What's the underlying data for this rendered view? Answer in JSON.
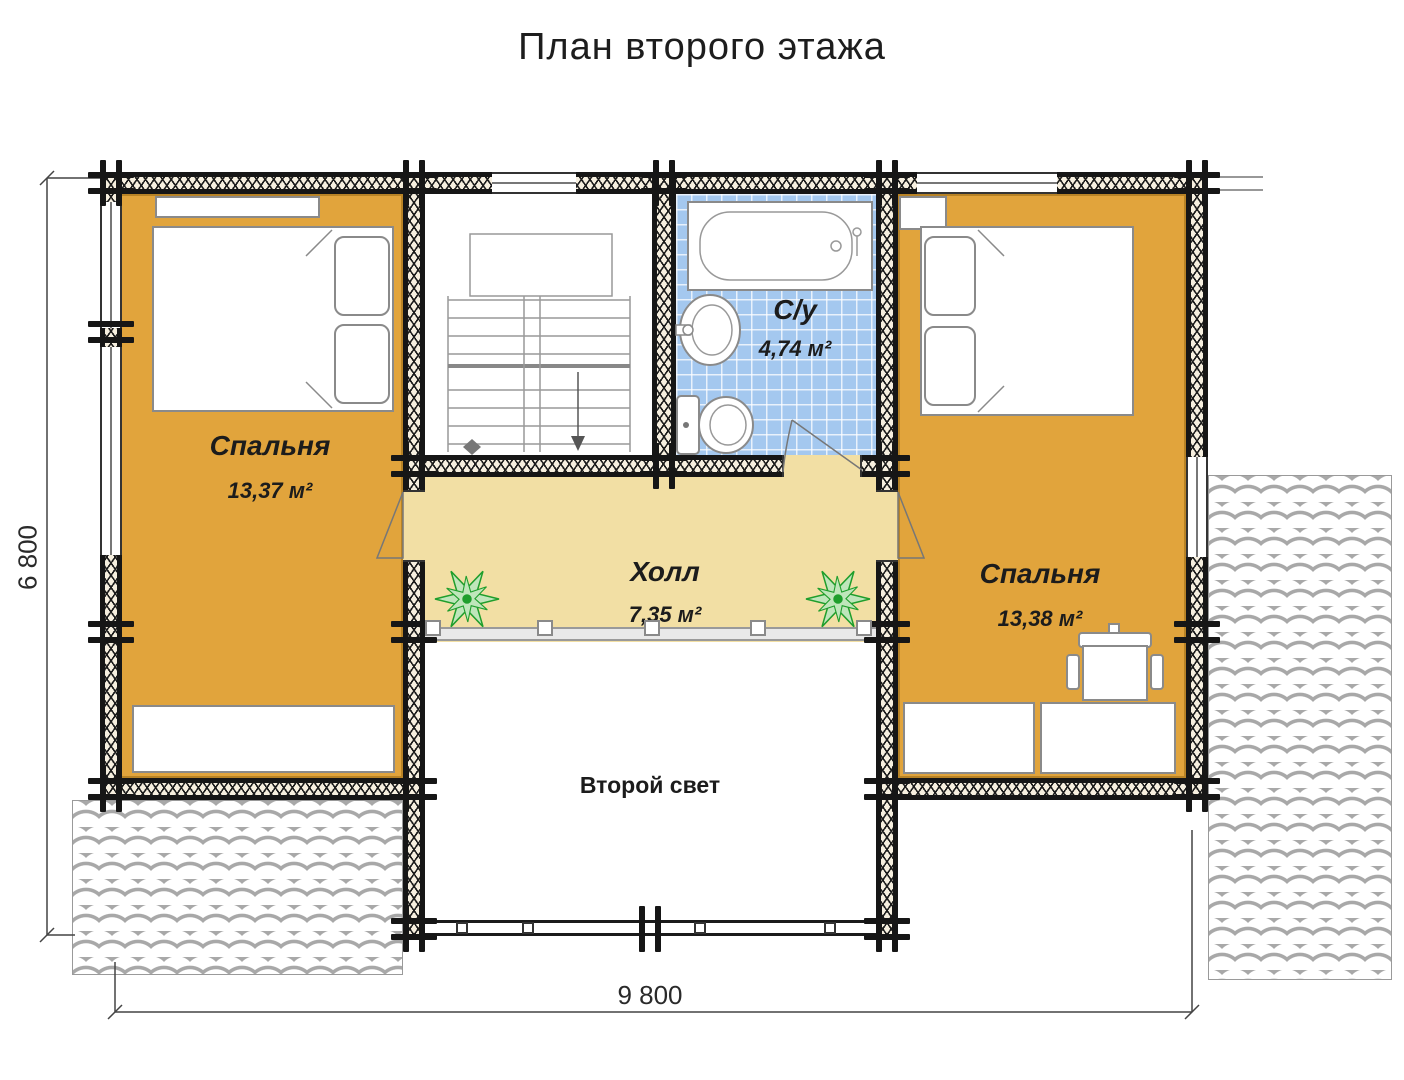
{
  "title": "План второго этажа",
  "rooms": {
    "bedroom_left": {
      "name": "Спальня",
      "area": "13,37 м²"
    },
    "bathroom": {
      "name": "С/у",
      "area": "4,74 м²"
    },
    "hall": {
      "name": "Холл",
      "area": "7,35 м²"
    },
    "bedroom_right": {
      "name": "Спальня",
      "area": "13,38 м²"
    },
    "void": {
      "name": "Второй свет"
    }
  },
  "dimensions": {
    "height": "6 800",
    "width": "9 800"
  },
  "colors": {
    "bedroom_floor": "#e1a43c",
    "hall_floor": "#f2dfa4",
    "bathroom_tile": "#a4c8ef",
    "wall": "#161616",
    "plant_green": "#1f9e2c",
    "line_gray": "#8a8a8a"
  }
}
